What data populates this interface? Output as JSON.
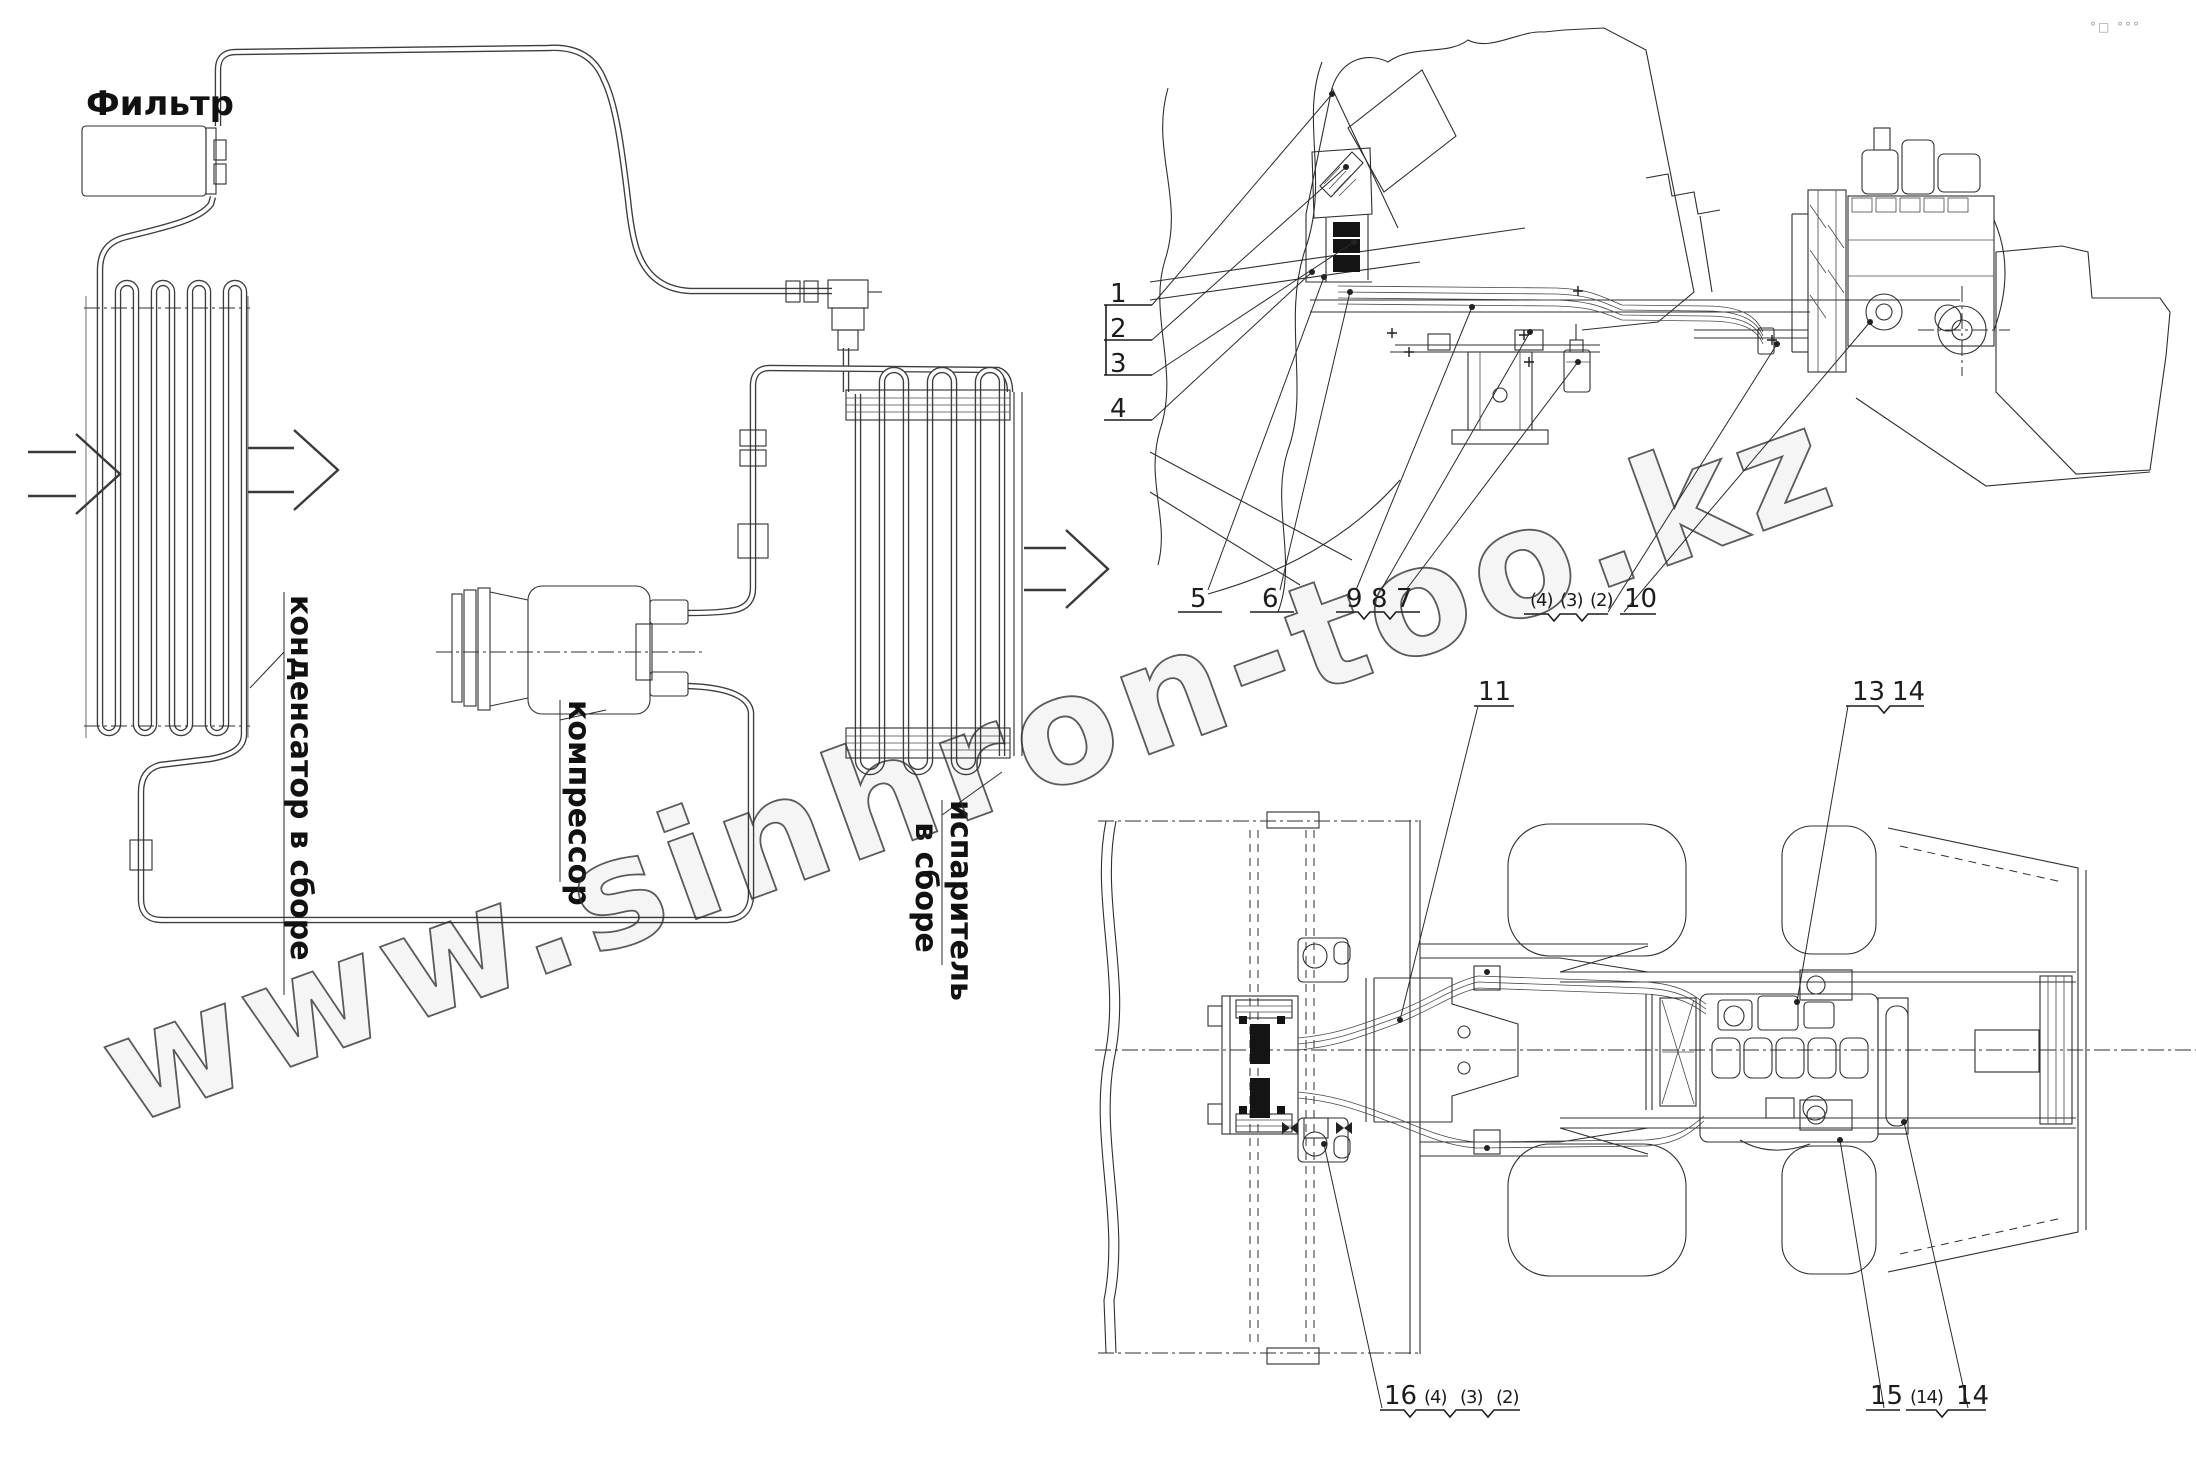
{
  "figure": {
    "watermark_text": "www.sinhron-too.kz",
    "corner_marks": "°□ °°°"
  },
  "schematic": {
    "filter_label": "Фильтр",
    "condenser_label": "конденсатор в сборе",
    "compressor_label": "компрессор",
    "evaporator_label_line1": "испаритель",
    "evaporator_label_line2": "в сборе"
  },
  "side_view_callouts": {
    "c1": "1",
    "c2": "2",
    "c3": "3",
    "c4": "4",
    "c5": "5",
    "c6": "6",
    "c9": "9",
    "c8": "8",
    "c7": "7",
    "p4": "(4)",
    "p3": "(3)",
    "p2": "(2)",
    "c10": "10"
  },
  "top_view_callouts": {
    "c11": "11",
    "c13": "13",
    "c14": "14",
    "c16": "16",
    "p4": "(4)",
    "p3": "(3)",
    "p2": "(2)",
    "c15": "15",
    "p14": "(14)",
    "c14b": "14"
  }
}
